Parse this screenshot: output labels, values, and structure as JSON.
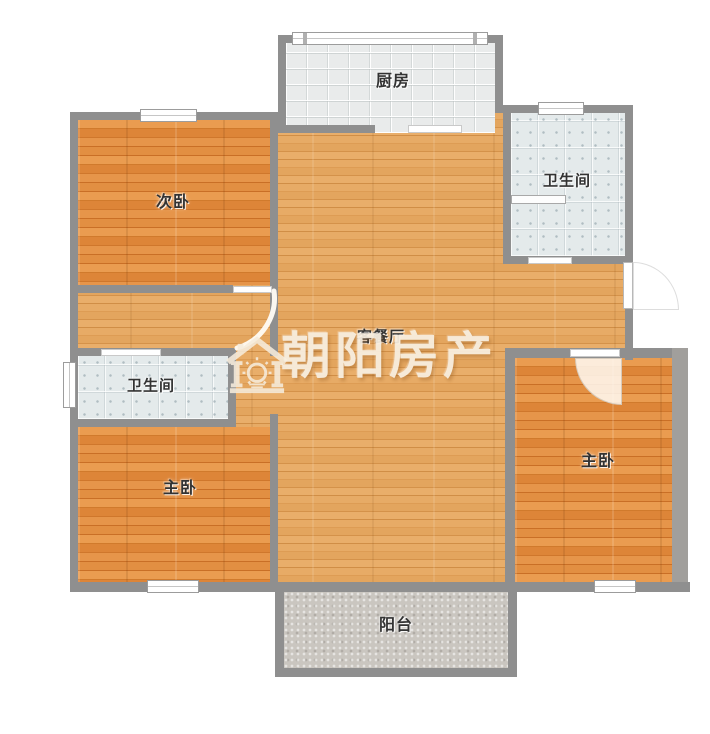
{
  "floorplan": {
    "watermark": {
      "text": "朝阳房产",
      "logo": "sunrise-house-logo"
    },
    "rooms": {
      "kitchen": {
        "label": "厨房"
      },
      "secondary_bedroom": {
        "label": "次卧"
      },
      "bathroom_top": {
        "label": "卫生间"
      },
      "living_dining": {
        "label": "客餐厅"
      },
      "bathroom_mid": {
        "label": "卫生间"
      },
      "master_bedroom_left": {
        "label": "主卧"
      },
      "master_bedroom_right": {
        "label": "主卧"
      },
      "balcony": {
        "label": "阳台"
      }
    },
    "colors": {
      "wall": "#8f8f8f",
      "wall_light": "#a19f9c",
      "wood_floor": "#dd8a3c",
      "living_floor": "#e1a059",
      "kitchen_tile": "#e9ebeb",
      "bath_tile": "#e4eaeb",
      "balcony_floor": "#cac6c0",
      "watermark": "#f8efe1",
      "label_text": "#333333"
    }
  }
}
